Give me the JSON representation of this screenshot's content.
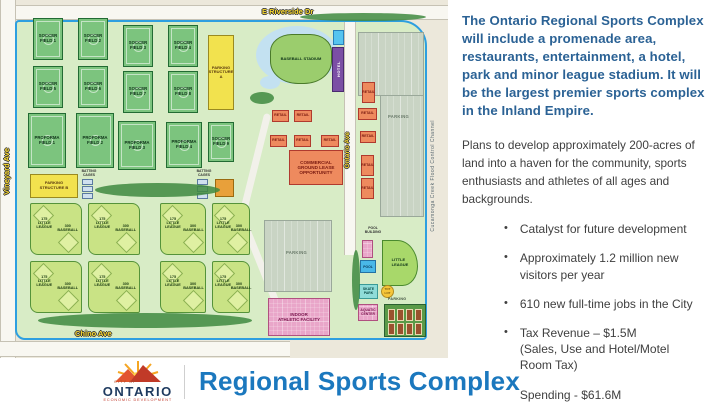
{
  "map": {
    "streets": {
      "e_riverside": "E Riverside Dr",
      "vineyard": "Vineyard Ave",
      "chino": "Chino Ave",
      "ontario": "Ontario Ave",
      "creek": "Cucamonga Creek Flood Control Channel"
    },
    "soccer_fields": [
      "SOCCER\nFIELD 1",
      "SOCCER\nFIELD 2",
      "SOCCER\nFIELD 3",
      "SOCCER\nFIELD 4",
      "SOCCER\nFIELD 5",
      "SOCCER\nFIELD 6",
      "SOCCER\nFIELD 7",
      "SOCCER\nFIELD 8",
      "SOCCER\nFIELD 9"
    ],
    "proforma_fields": [
      "PROFORMA\nFIELD 1",
      "PROFORMA\nFIELD 2",
      "PROFORMA\nFIELD 3",
      "PROFORMA\nFIELD 4"
    ],
    "labels": {
      "parking_structure_a": "PARKING\nSTRUCTURE\nA",
      "parking_structure_b": "PARKING\nSTRUCTURE B",
      "batting_cages": "BATTING\nCAGES",
      "little_league": "175\nLITTLE\nLEAGUE",
      "baseball": "300\nBASEBALL",
      "retail": "RETAIL",
      "commercial": "COMMERCIAL\nGROUND LEASE\nOPPORTUNITY",
      "baseball_stadium": "BASEBALL STADIUM",
      "hotel": "HOTEL",
      "parking": "PARKING",
      "pool_building": "POOL\nBUILDING",
      "pool": "POOL",
      "skate_park": "SKATE\nPARK",
      "tot_lot": "TOT\nLOT",
      "aquatic_center": "AQUATIC\nCENTER",
      "little_league_field": "LITTLE\nLEAGUE",
      "indoor_athletic_facility": "INDOOR\nATHLETIC FACILITY"
    }
  },
  "right_panel": {
    "headline": "The Ontario Regional Sports Complex will include a promenade area, restaurants, entertainment, a hotel, park and minor league stadium. It will be the largest premier sports complex in the Inland Empire.",
    "paragraph": "Plans to develop approximately 200-acres of land into a haven for the community, sports enthusiasts and athletes of all ages and backgrounds.",
    "bullets": [
      "Catalyst for future development",
      "Approximately 1.2 million new visitors per year",
      "610 new full-time jobs in the City",
      "Tax Revenue – $1.5M\n(Sales, Use and Hotel/Motel Room Tax)",
      "Spending - $61.6M\n(net direct, indirect and induced)"
    ]
  },
  "footer": {
    "city_of": "CITY OF",
    "city_name": "ONTARIO",
    "dept": "ECONOMIC DEVELOPMENT",
    "title": "Regional Sports Complex"
  },
  "colors": {
    "headline_blue": "#2B6295",
    "title_blue": "#1B78BE",
    "site_green": "#D8ECC6",
    "field_green": "#7CC47E",
    "little_league_green": "#C9E385",
    "retail_orange": "#EE8A5E",
    "hotel_purple": "#7B4FA5",
    "parking_yellow": "#F2E24E",
    "boundary_blue": "#2D9FE0"
  }
}
